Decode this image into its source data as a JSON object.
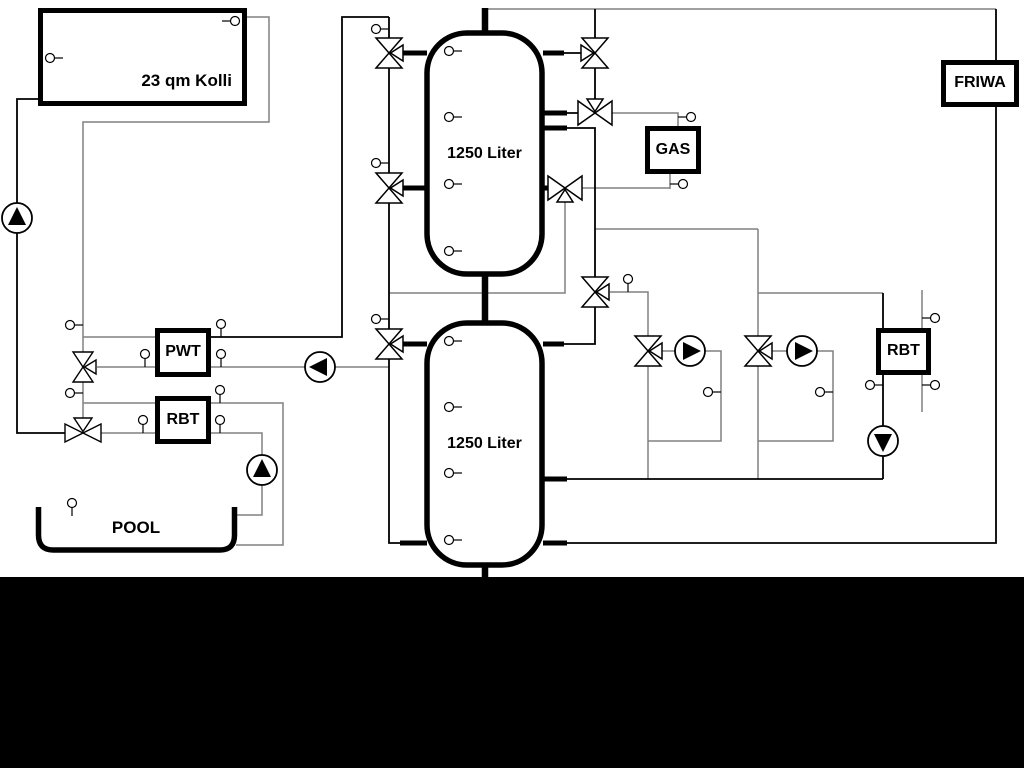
{
  "components": {
    "solar_collector": {
      "label": "23 qm Kolli"
    },
    "buffer_tank_upper": {
      "label": "1250 Liter"
    },
    "buffer_tank_lower": {
      "label": "1250 Liter"
    },
    "pwt_heat_exchanger": {
      "label": "PWT"
    },
    "pool_rbt_heat_exchanger": {
      "label": "RBT"
    },
    "gas_boiler": {
      "label": "GAS"
    },
    "dhw_rbt_heat_exchanger": {
      "label": "RBT"
    },
    "fresh_water_station": {
      "label": "FRIWA"
    },
    "swimming_pool": {
      "label": "POOL"
    }
  },
  "colors": {
    "pipe_gray": "#808080",
    "pipe_black": "#000000",
    "background": "#ffffff",
    "letterbox": "#000000"
  }
}
